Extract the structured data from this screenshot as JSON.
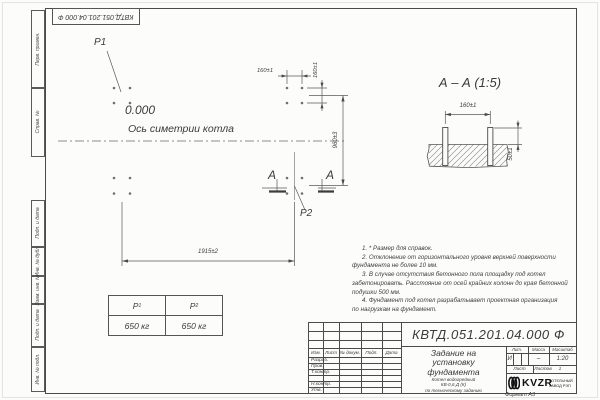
{
  "colors": {
    "paper": "#fcfcfb",
    "line": "#4a4a4a",
    "text": "#3a3a3a",
    "logo": "#111111"
  },
  "doc": {
    "designation": "КВТД.051.201.04.000 Ф"
  },
  "margins": {
    "left_top": [
      "Перв. примен.",
      "Справ. №"
    ],
    "left_bottom": [
      "Подп. и дата",
      "Инв. № дубл.",
      "Взам. инв. №",
      "Подп. и дата",
      "Инв. № подл."
    ]
  },
  "plan": {
    "p1": "Р1",
    "p2": "Р2",
    "level_mark": "0.000",
    "axis_label": "Ось симетрии котла",
    "dim_top": "160±1",
    "dim_col": "160±1",
    "dim_right": "960±3",
    "dim_bottom": "1915±2",
    "section_letter": "А"
  },
  "section": {
    "title": "А – А (1:5)",
    "dim_width": "160±1",
    "dim_height": "50±1"
  },
  "load_table": {
    "p1_label": "Р",
    "p1_sub": "1",
    "p1_value": "650 кг",
    "p2_label": "Р",
    "p2_sub": "2",
    "p2_value": "650 кг"
  },
  "notes": {
    "lines": [
      "1. * Размер для справок.",
      "2. Отклонение от горизонтального уровня верхней поверхности",
      "фундамента не более 10 мм.",
      "3. В случае отсутствия бетонного пола площадку под котел",
      "забетонировать. Расстояние от осей крайних колонн до края бетонной",
      "подушки 500 мм.",
      "4. Фундамент под котел разрабатывает проектная организация",
      "по нагрузкам на фундамент."
    ]
  },
  "title_block": {
    "header_cells": [
      "Изм.",
      "Лист",
      "№ докум.",
      "Подп.",
      "Дата"
    ],
    "row_labels": [
      "Разраб.",
      "Пров.",
      "Т.контр.",
      "",
      "Н.контр.",
      "Утв."
    ],
    "title_lines": [
      "Задание на",
      "установку",
      "фундамента"
    ],
    "subtitle_lines": [
      "Котел водогрейный",
      "КВ-0,6 Д (К)",
      "по техническому заданию"
    ],
    "lit_header": "Лит.",
    "mass_header": "Масса",
    "scale_header": "Масштаб",
    "lit_value": "И",
    "mass_value": "–",
    "scale_value": "1:20",
    "sheet_label": "Лист",
    "sheets_label": "Листов",
    "sheets_value": "1",
    "logo_text": "KVZR",
    "logo_caption_lines": [
      "КОТЕЛЬНЫЙ",
      "ЗАВОД РЭП"
    ],
    "format_label": "Формат А3"
  }
}
